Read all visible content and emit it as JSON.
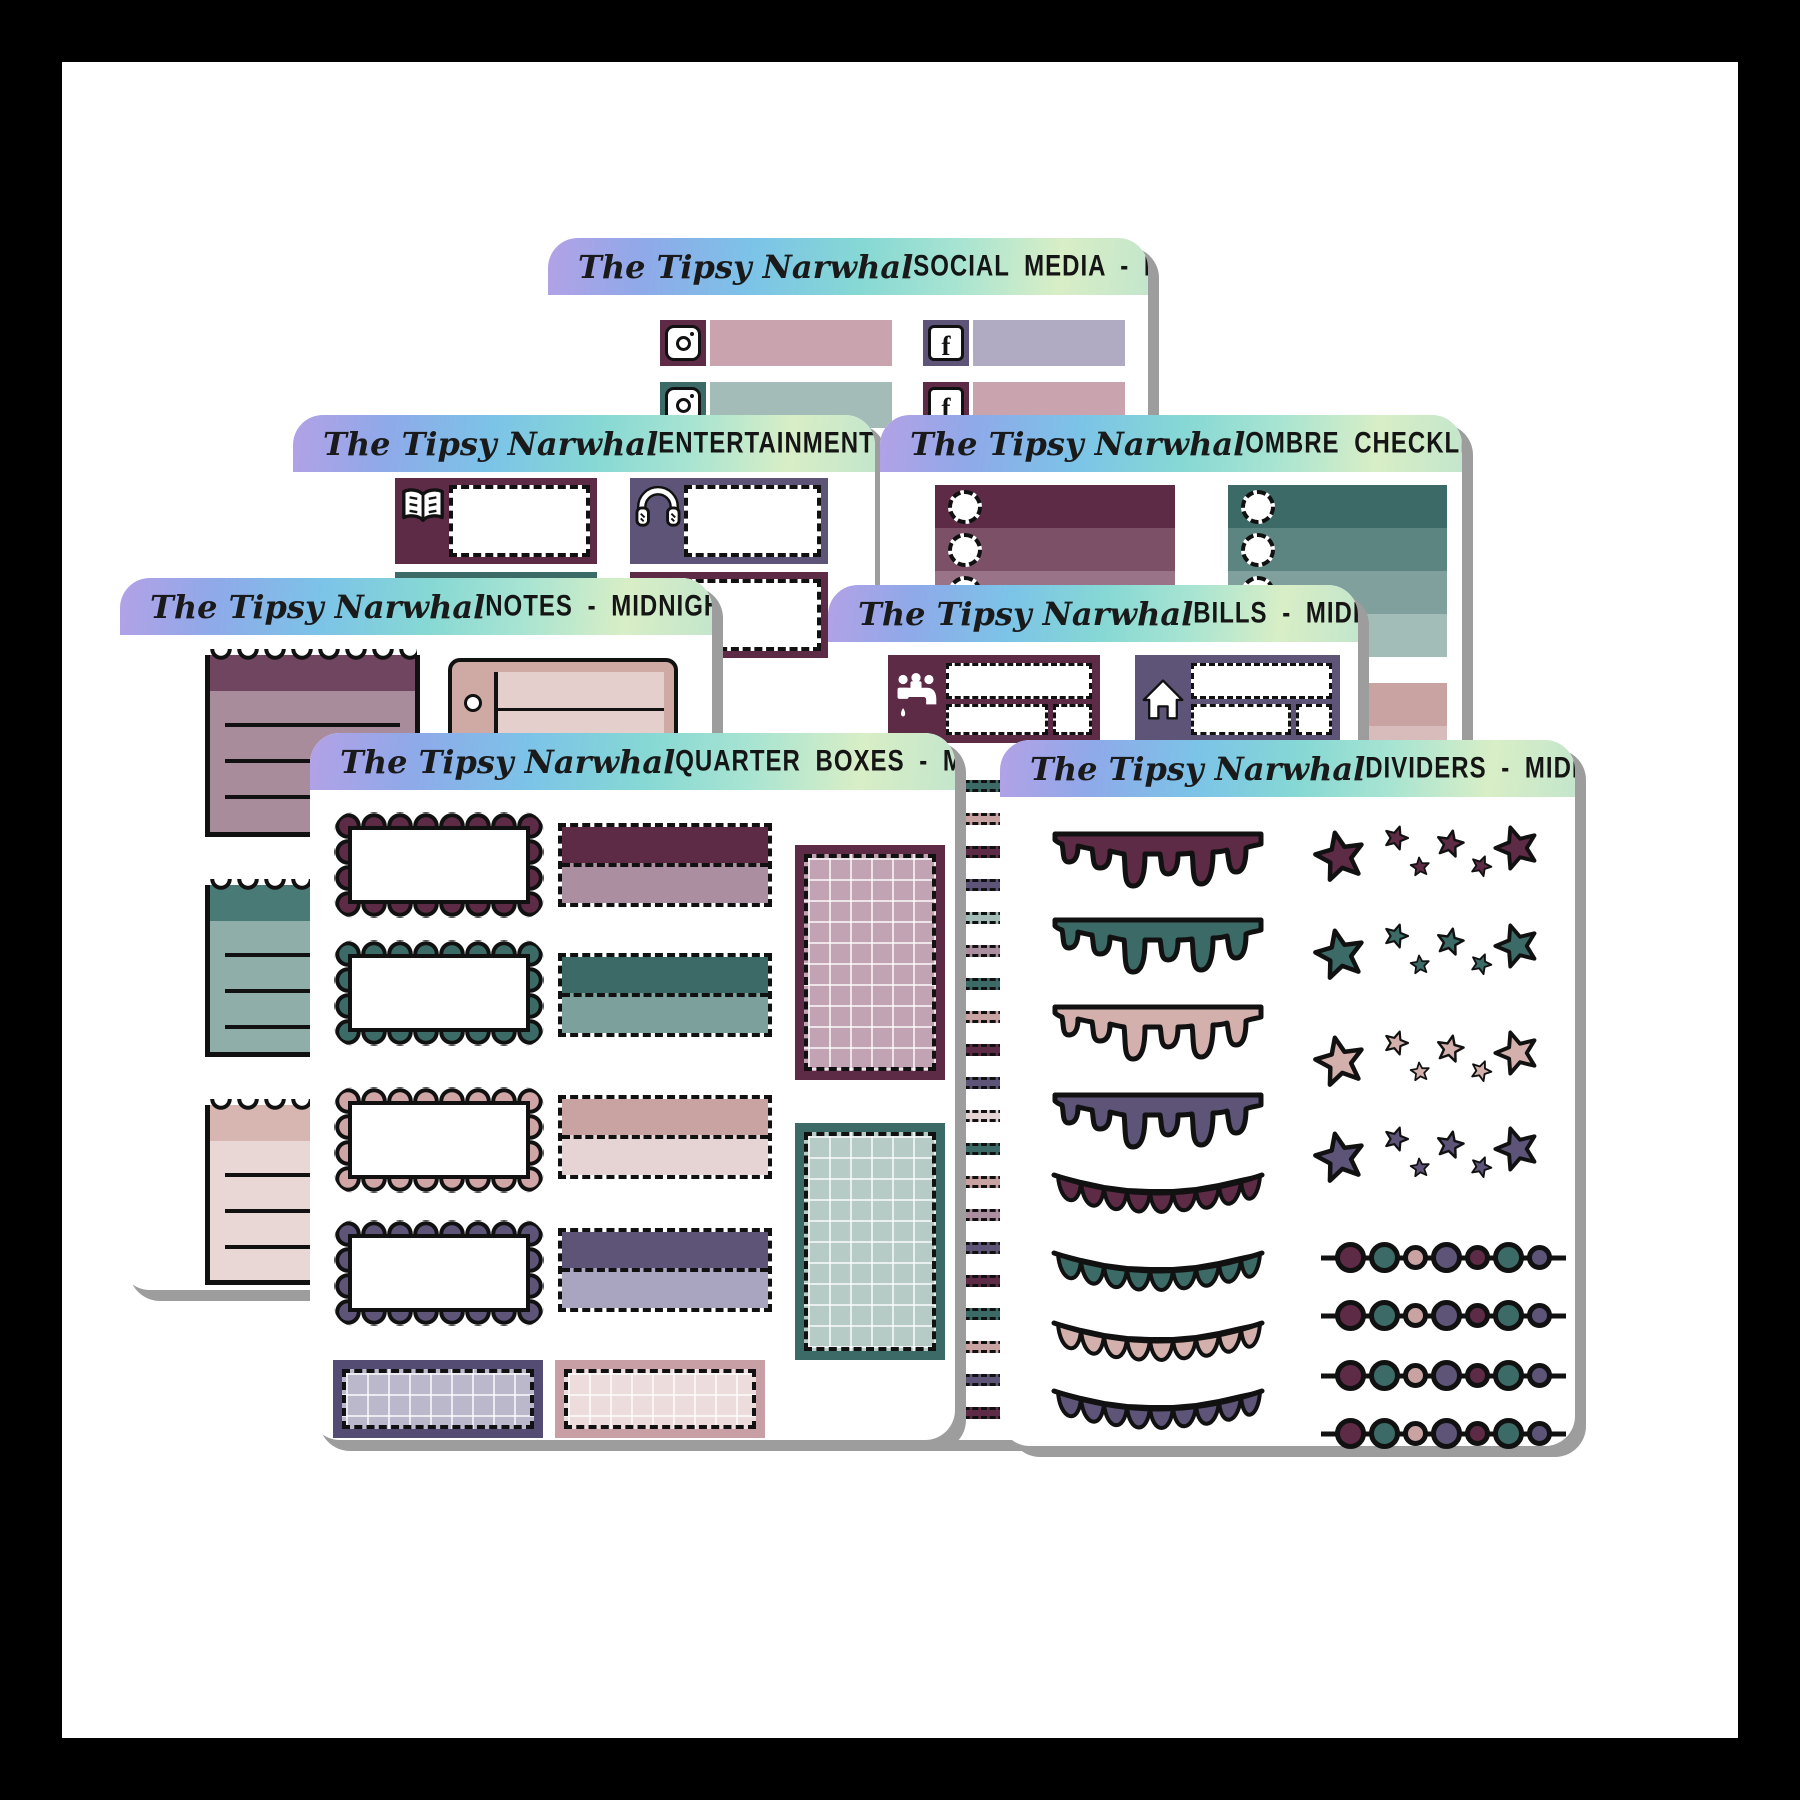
{
  "brand": "The Tipsy Narwhal",
  "collection": "Midnight Peonies",
  "background": "#ffffff",
  "frame_color": "#000000",
  "shadow_color": "#9d9d9d",
  "header": {
    "gradient": [
      "#b3a1e6",
      "#8fa9e9",
      "#7cc3e8",
      "#86d8d4",
      "#a8e4d2",
      "#d8eec6"
    ]
  },
  "palette": {
    "plum": "#5e2b47",
    "plum_mid": "#7c5168",
    "plum_light": "#997387",
    "mauve": "#ab8fa0",
    "teal": "#3c6b67",
    "teal_mid": "#5c8480",
    "teal_light": "#7fa09c",
    "sage": "#a3bcb8",
    "dusty_pink": "#c9a2a2",
    "pink_light": "#e6d4d4",
    "pink_bar": "#c9a4ae",
    "purple": "#5d5478",
    "purple_light": "#a9a4c0",
    "lavender": "#b0abc2"
  },
  "sheets": [
    {
      "id": "social-media",
      "title": "SOCIAL MEDIA - MIDNIGHT PEONIES",
      "stickers": [
        {
          "icon": "instagram-icon",
          "tile": "#5e2b47",
          "bar": "#c9a4ae"
        },
        {
          "icon": "facebook-icon",
          "tile": "#5d5478",
          "bar": "#b0abc2"
        },
        {
          "icon": "instagram-icon",
          "tile": "#3c6b67",
          "bar": "#a3bcb8"
        },
        {
          "icon": "facebook-icon",
          "tile": "#5e2b47",
          "bar": "#c9a4ae"
        }
      ]
    },
    {
      "id": "entertainment",
      "title": "ENTERTAINMENT - MIDNIGHT PEONIES",
      "stickers": [
        {
          "icon": "book-icon",
          "box": "#5e2b47"
        },
        {
          "icon": "headphones-icon",
          "box": "#5d5478"
        },
        {
          "icon": "book-icon",
          "box": "#3c6b67"
        },
        {
          "icon": "tv-icon",
          "box": "#5e2b47"
        }
      ]
    },
    {
      "id": "ombre-checklists",
      "title": "OMBRE CHECKLISTS - MIDNIGHT PEONIES",
      "checklists": [
        {
          "name": "plum-ombre",
          "shades": [
            "#5e2b47",
            "#7c5168",
            "#997387"
          ]
        },
        {
          "name": "teal-ombre",
          "shades": [
            "#3c6b67",
            "#5c8480",
            "#7fa09c",
            "#a2bcb8"
          ]
        },
        {
          "name": "pink-ombre",
          "shades": [
            "#c9a2a2",
            "#d8bcbc",
            "#e6d4d4"
          ]
        }
      ]
    },
    {
      "id": "notes",
      "title": "NOTES - MIDNIGHT PEONIES",
      "stickers": [
        {
          "name": "torn-note",
          "top": "#6f4560",
          "body": "#a88c9c"
        },
        {
          "name": "ring-notepad",
          "frame": "#cfa9a4",
          "panel": "#e4cfcc"
        },
        {
          "name": "torn-note",
          "top": "#4a7a75",
          "body": "#8fada9"
        },
        {
          "name": "torn-note",
          "top": "#d7b5b1",
          "body": "#e8d7d5"
        }
      ]
    },
    {
      "id": "bills",
      "title": "BILLS - MIDIGHT PEONIES",
      "stickers": [
        {
          "icon": "faucet-icon",
          "box": "#5e2b47"
        },
        {
          "icon": "house-icon",
          "box": "#5d5478"
        }
      ]
    },
    {
      "id": "quarter-boxes",
      "title": "QUARTER BOXES - MIDNIGHT PEONIES",
      "rows": [
        {
          "scallop": "#5e2b47",
          "quarter": [
            "#5e2b47",
            "#ab8fa0"
          ]
        },
        {
          "scallop": "#3c6b67",
          "quarter": [
            "#3c6b67",
            "#7ca19d"
          ]
        },
        {
          "scallop": "#cfa5a5",
          "quarter": [
            "#c9a2a2",
            "#e6d4d4"
          ]
        },
        {
          "scallop": "#5d5478",
          "quarter": [
            "#5d5478",
            "#a9a4c0"
          ]
        }
      ],
      "grid_boxes": [
        {
          "frame": "#5e2b47",
          "fill": "#c2a3b3"
        },
        {
          "frame": "#3c6b67",
          "fill": "#b6cac6"
        },
        {
          "frame": "#554c73",
          "fill": "#bcb8cc"
        },
        {
          "frame": "#c79fa4",
          "fill": "#ecdcdc"
        }
      ]
    },
    {
      "id": "dividers",
      "title": "DIVIDERS - MIDNIGHT PEONIES",
      "divider_styles": [
        "drip",
        "star-cluster",
        "bunting",
        "bead-string"
      ],
      "divider_colors": [
        "#5e2b47",
        "#3c6b67",
        "#d4b0ac",
        "#5d5478"
      ]
    }
  ]
}
